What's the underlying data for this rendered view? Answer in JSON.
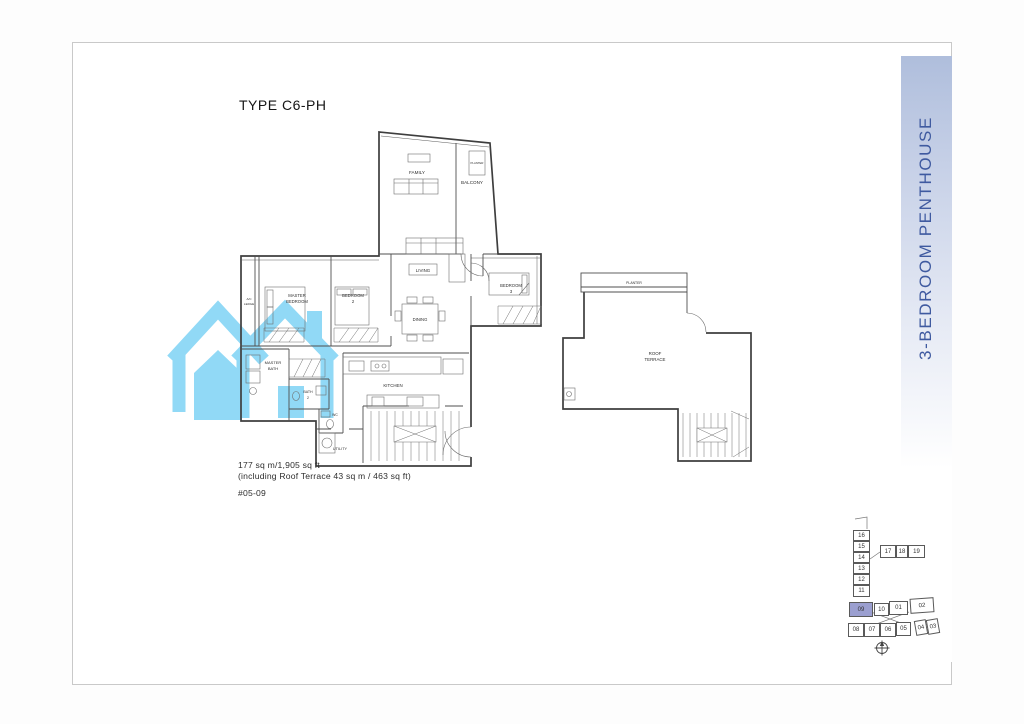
{
  "document": {
    "title": "TYPE C6-PH",
    "area_line1": "177 sq m/1,905 sq ft",
    "area_line2": "(including Roof Terrace 43 sq m / 463 sq ft)",
    "unit_number": "#05-09",
    "category_label": "3-BEDROOM PENTHOUSE"
  },
  "floor_plan": {
    "labels": {
      "family": "FAMILY",
      "balcony": "BALCONY",
      "planter": "PLANTER",
      "living": "LIVING",
      "dining": "DINING",
      "bedroom3_1": "BEDROOM",
      "bedroom3_2": "3",
      "master_bedroom_1": "MASTER",
      "master_bedroom_2": "BEDROOM",
      "bedroom2_1": "BEDROOM",
      "bedroom2_2": "2",
      "ac_ledge_1": "A/C",
      "ac_ledge_2": "LEDGE",
      "master_bath_1": "MASTER",
      "master_bath_2": "BATH",
      "bath2_1": "BATH",
      "bath2_2": "2",
      "wc": "WC",
      "kitchen": "KITCHEN",
      "utility": "UTILITY"
    }
  },
  "roof_plan": {
    "labels": {
      "planter": "PLANTER",
      "roof_terrace_1": "ROOF",
      "roof_terrace_2": "TERRACE"
    }
  },
  "locator": {
    "highlighted_unit": "09",
    "tower": [
      "16",
      "15",
      "14",
      "13",
      "12",
      "11"
    ],
    "upper_row": [
      "17",
      "18",
      "19"
    ],
    "middle_row": [
      "09",
      "10",
      "01",
      "02"
    ],
    "lower_row": [
      "08",
      "07",
      "06",
      "05",
      "04",
      "03"
    ]
  },
  "icons": {
    "watermark": "twin-house-icon",
    "compass": "north-compass-icon"
  },
  "colors": {
    "watermark_blue": "#8DD8F6",
    "sidebar_text": "#3F5AA0",
    "sidebar_gradient_top": "#AFBEDC",
    "locator_highlight": "#9B9FD0",
    "plan_line": "#3E3E3E"
  }
}
